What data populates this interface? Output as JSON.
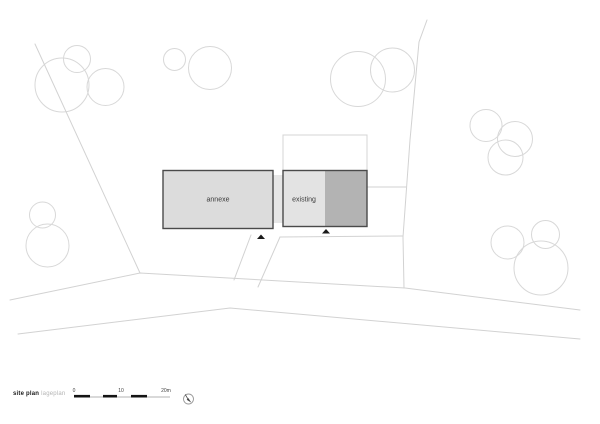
{
  "meta": {
    "width": 600,
    "height": 424,
    "background": "#ffffff"
  },
  "legend": {
    "title": "site plan",
    "subtitle": "lageplan",
    "scale_bar": {
      "x_start": 74,
      "x_end": 170,
      "y": 397,
      "solid_segments": [
        [
          74,
          90
        ],
        [
          103,
          117
        ],
        [
          131,
          147
        ]
      ],
      "labels": [
        {
          "text": "0",
          "x": 74
        },
        {
          "text": "10",
          "x": 121
        },
        {
          "text": "20m",
          "x": 166
        }
      ],
      "line_color": "#9a9a9a",
      "segment_color": "#141414",
      "label_color": "#444444"
    },
    "north_arrow": {
      "cx": 188.5,
      "cy": 399,
      "r": 5,
      "circle_color": "#9a9a9a",
      "needle_color": "#444444"
    }
  },
  "site": {
    "colors": {
      "tree_stroke": "#d8d8d8",
      "boundary_stroke": "#d2d2d2",
      "building_stroke": "#4a4a4a",
      "annexe_fill": "#dcdcdc",
      "existing_fill_light": "#e3e3e3",
      "existing_fill_dark": "#b3b3b3",
      "connector_fill": "#e6e6e6",
      "outline_fill": "#ffffff",
      "outline_stroke": "#d4d4d4",
      "marker_fill": "#1a1a1a",
      "label_color": "#3a3a3a"
    },
    "buildings": [
      {
        "id": "annexe",
        "label": "annexe",
        "x": 163,
        "y": 170.5,
        "w": 110,
        "h": 58,
        "label_x": 218,
        "label_y": 201.5
      },
      {
        "id": "existing",
        "label": "existing",
        "x": 283,
        "y": 170.5,
        "w": 84,
        "h": 56,
        "split_x": 325,
        "label_x": 304,
        "label_y": 201.5
      }
    ],
    "connector": {
      "x": 272.5,
      "y": 175,
      "w": 11,
      "h": 48
    },
    "outline_rect": {
      "x": 283,
      "y": 135,
      "w": 84,
      "h": 36
    },
    "entrance_markers": [
      {
        "points": "257,239 265,239 261,234.5"
      },
      {
        "points": "322,233.5 330,233.5 326,229"
      }
    ],
    "trees": [
      {
        "cx": 62,
        "cy": 85,
        "r": 27
      },
      {
        "cx": 77,
        "cy": 59,
        "r": 13.5
      },
      {
        "cx": 105.5,
        "cy": 87,
        "r": 18.5
      },
      {
        "cx": 174.5,
        "cy": 59.5,
        "r": 11
      },
      {
        "cx": 210,
        "cy": 68,
        "r": 21.5
      },
      {
        "cx": 358,
        "cy": 79,
        "r": 27.5
      },
      {
        "cx": 392.5,
        "cy": 70,
        "r": 22
      },
      {
        "cx": 486,
        "cy": 125.5,
        "r": 16
      },
      {
        "cx": 515,
        "cy": 139,
        "r": 17.5
      },
      {
        "cx": 505.5,
        "cy": 157.5,
        "r": 17.5
      },
      {
        "cx": 42.5,
        "cy": 215,
        "r": 13
      },
      {
        "cx": 47.5,
        "cy": 245.5,
        "r": 21.5
      },
      {
        "cx": 507.5,
        "cy": 242.5,
        "r": 16.5
      },
      {
        "cx": 545.5,
        "cy": 234.5,
        "r": 14
      },
      {
        "cx": 541,
        "cy": 268,
        "r": 27
      }
    ],
    "boundaries": [
      {
        "name": "northwest-boundary-line",
        "points": [
          [
            35,
            44
          ],
          [
            140,
            273
          ]
        ]
      },
      {
        "name": "road-upper-edge-line",
        "points": [
          [
            10,
            300
          ],
          [
            140,
            273
          ],
          [
            405,
            288
          ],
          [
            580,
            310
          ]
        ]
      },
      {
        "name": "road-lower-edge-line",
        "points": [
          [
            18,
            334
          ],
          [
            230,
            308
          ],
          [
            580,
            339
          ]
        ]
      },
      {
        "name": "east-boundary-line",
        "points": [
          [
            427,
            20
          ],
          [
            419,
            42
          ],
          [
            410,
            140
          ],
          [
            403,
            237
          ],
          [
            404,
            288
          ]
        ]
      },
      {
        "name": "side-fence-line",
        "points": [
          [
            367,
            187
          ],
          [
            406,
            187
          ]
        ]
      },
      {
        "name": "driveway-top-line",
        "points": [
          [
            280,
            237
          ],
          [
            403,
            236
          ]
        ]
      },
      {
        "name": "driveway-left-line",
        "points": [
          [
            280,
            237
          ],
          [
            258,
            287
          ]
        ]
      },
      {
        "name": "footpath-line",
        "points": [
          [
            251,
            235
          ],
          [
            234,
            280
          ]
        ]
      }
    ]
  }
}
